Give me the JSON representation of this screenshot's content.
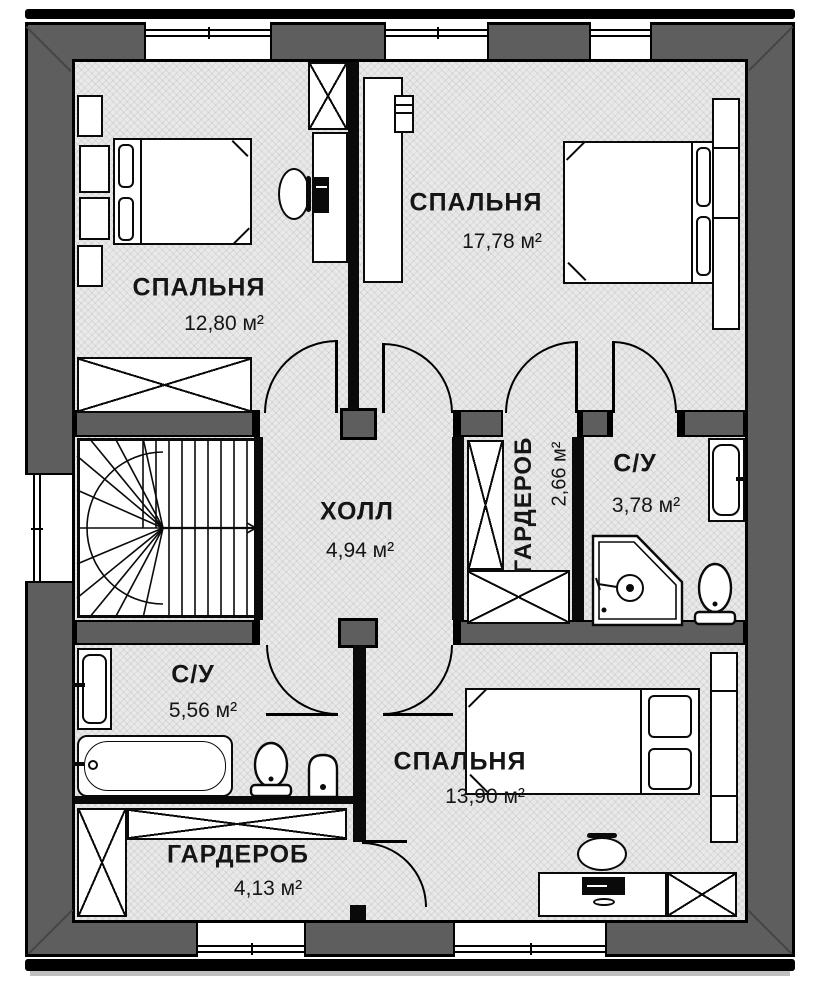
{
  "plan": {
    "type": "floor-plan",
    "language": "ru",
    "rooms": [
      {
        "id": "bedroom-1",
        "name": "СПАЛЬНЯ",
        "area": "12,80 м²"
      },
      {
        "id": "bedroom-2",
        "name": "СПАЛЬНЯ",
        "area": "17,78 м²"
      },
      {
        "id": "hall",
        "name": "ХОЛЛ",
        "area": "4,94 м²"
      },
      {
        "id": "wardrobe-small",
        "name": "ГАРДЕРОБ",
        "area": "2,66 м²"
      },
      {
        "id": "bathroom-small",
        "name": "С/У",
        "area": "3,78 м²"
      },
      {
        "id": "bathroom-large",
        "name": "С/У",
        "area": "5,56 м²"
      },
      {
        "id": "bedroom-3",
        "name": "СПАЛЬНЯ",
        "area": "13,90 м²"
      },
      {
        "id": "wardrobe-large",
        "name": "ГАРДЕРОБ",
        "area": "4,13 м²"
      }
    ],
    "colors": {
      "wall": "#5e5e5e",
      "floor": "#e9e9e9",
      "line": "#000000"
    }
  }
}
